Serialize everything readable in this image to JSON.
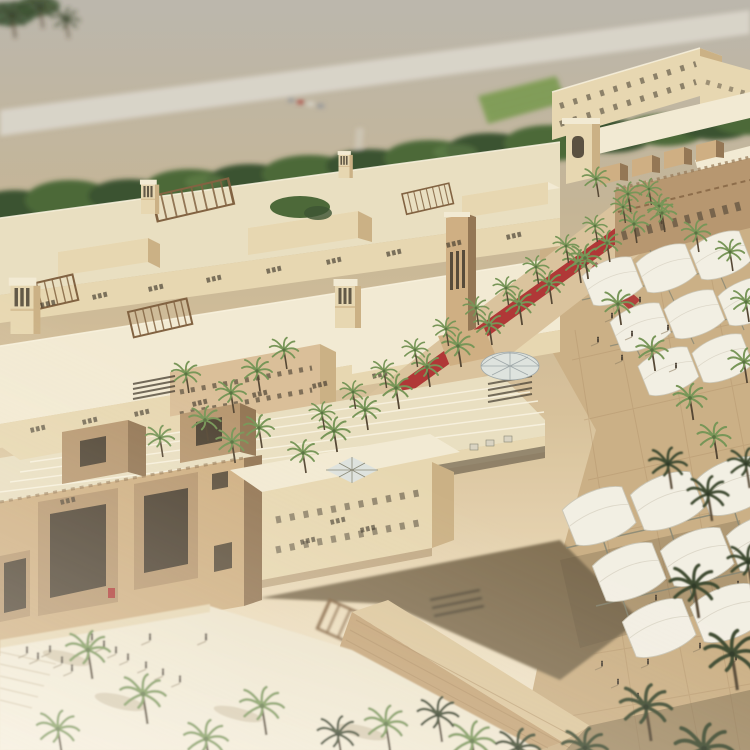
{
  "palette": {
    "desert": "#b8b4ab",
    "road": "#d7d3c9",
    "tree_dark": "#2f4a28",
    "tree_mid": "#41602f",
    "tree_light": "#5b7d42",
    "roof_light": "#f3ebd4",
    "roof_mid": "#e9dfc1",
    "wall_lit": "#e7d7b0",
    "wall_shadow": "#c9ae81",
    "wall_deep": "#9a7c55",
    "sandstone_lit": "#cdac7e",
    "sandstone_mid": "#b3926a",
    "sandstone_shadow": "#8d6f4d",
    "carpet_red": "#a81f24",
    "palm_green": "#6f9150",
    "palm_dark": "#333f27",
    "trunk": "#4b3d2b",
    "canopy_white": "#f3f0e6",
    "canopy_shade": "#e2ded0",
    "frame_gray": "#80816f",
    "paver": "#c9ad82",
    "paver_shade": "#9b8260",
    "plaza_bright": "#f2ecdc",
    "wall_brick": "#c2a073",
    "brick_course": "#a5845a",
    "glass_light": "#dde3e0",
    "wood": "#7a5a38",
    "opening_dark": "#352d22",
    "facade_pink": "#d9bd96",
    "avenue_sand": "#d9c19a",
    "people": "#3f362b",
    "person_shadow": "#8a795d",
    "grid_line": "#a7885e",
    "parapet_light": "#faf4e2",
    "crop_green": "#7d9b52",
    "crop_row": "#5d7a3c",
    "step_line": "#cdbfa2",
    "shadow_warm": "#6b5a41",
    "car_red": "#a8433a",
    "car_gray": "#8b9095",
    "car_light": "#d8d5cc"
  },
  "scene": {
    "palms": [
      {
        "x": 12,
        "y": 16,
        "s": 1.1,
        "v": "dark",
        "l": "far"
      },
      {
        "x": 40,
        "y": 8,
        "s": 1.0,
        "v": "dark",
        "l": "far"
      },
      {
        "x": 66,
        "y": 20,
        "s": 0.9,
        "v": "dark",
        "l": "far"
      },
      {
        "x": 303,
        "y": 453,
        "s": 1.0
      },
      {
        "x": 334,
        "y": 431,
        "s": 1.05
      },
      {
        "x": 365,
        "y": 410,
        "s": 1.0
      },
      {
        "x": 396,
        "y": 388,
        "s": 1.05
      },
      {
        "x": 427,
        "y": 367,
        "s": 1.0
      },
      {
        "x": 458,
        "y": 346,
        "s": 1.05
      },
      {
        "x": 489,
        "y": 325,
        "s": 1.0
      },
      {
        "x": 519,
        "y": 304,
        "s": 1.05
      },
      {
        "x": 549,
        "y": 284,
        "s": 1.0
      },
      {
        "x": 578,
        "y": 263,
        "s": 1.0
      },
      {
        "x": 607,
        "y": 243,
        "s": 0.95
      },
      {
        "x": 634,
        "y": 224,
        "s": 0.95
      },
      {
        "x": 659,
        "y": 206,
        "s": 0.9
      },
      {
        "x": 322,
        "y": 413,
        "s": 0.85
      },
      {
        "x": 353,
        "y": 392,
        "s": 0.85
      },
      {
        "x": 384,
        "y": 371,
        "s": 0.85
      },
      {
        "x": 415,
        "y": 350,
        "s": 0.85
      },
      {
        "x": 446,
        "y": 329,
        "s": 0.85
      },
      {
        "x": 476,
        "y": 308,
        "s": 0.85
      },
      {
        "x": 506,
        "y": 288,
        "s": 0.85
      },
      {
        "x": 536,
        "y": 267,
        "s": 0.85
      },
      {
        "x": 566,
        "y": 246,
        "s": 0.85
      },
      {
        "x": 595,
        "y": 226,
        "s": 0.8
      },
      {
        "x": 623,
        "y": 207,
        "s": 0.8
      },
      {
        "x": 649,
        "y": 189,
        "s": 0.8
      },
      {
        "x": 231,
        "y": 393,
        "s": 1.0
      },
      {
        "x": 257,
        "y": 371,
        "s": 1.0
      },
      {
        "x": 284,
        "y": 350,
        "s": 0.95
      },
      {
        "x": 205,
        "y": 420,
        "s": 1.05
      },
      {
        "x": 232,
        "y": 442,
        "s": 1.05
      },
      {
        "x": 186,
        "y": 374,
        "s": 0.95
      },
      {
        "x": 259,
        "y": 428,
        "s": 1.0
      },
      {
        "x": 160,
        "y": 438,
        "s": 0.95
      },
      {
        "x": 585,
        "y": 258,
        "s": 1.05
      },
      {
        "x": 618,
        "y": 304,
        "s": 1.05
      },
      {
        "x": 652,
        "y": 350,
        "s": 1.05
      },
      {
        "x": 690,
        "y": 398,
        "s": 1.1
      },
      {
        "x": 714,
        "y": 437,
        "s": 1.1
      },
      {
        "x": 596,
        "y": 179,
        "s": 0.9
      },
      {
        "x": 628,
        "y": 194,
        "s": 0.9
      },
      {
        "x": 662,
        "y": 213,
        "s": 0.95
      },
      {
        "x": 696,
        "y": 233,
        "s": 0.95
      },
      {
        "x": 730,
        "y": 252,
        "s": 0.95
      },
      {
        "x": 746,
        "y": 302,
        "s": 1.0
      },
      {
        "x": 744,
        "y": 362,
        "s": 1.05
      },
      {
        "x": 88,
        "y": 650,
        "s": 1.45,
        "l": "f"
      },
      {
        "x": 143,
        "y": 694,
        "s": 1.5,
        "l": "f"
      },
      {
        "x": 262,
        "y": 706,
        "s": 1.45,
        "l": "f"
      },
      {
        "x": 386,
        "y": 724,
        "s": 1.4,
        "l": "f"
      },
      {
        "x": 58,
        "y": 729,
        "s": 1.4,
        "l": "f"
      },
      {
        "x": 472,
        "y": 741,
        "s": 1.5,
        "l": "f"
      },
      {
        "x": 206,
        "y": 739,
        "s": 1.45,
        "l": "f"
      },
      {
        "x": 668,
        "y": 464,
        "s": 1.25,
        "v": "dark",
        "l": "f"
      },
      {
        "x": 708,
        "y": 494,
        "s": 1.35,
        "v": "dark",
        "l": "f"
      },
      {
        "x": 746,
        "y": 464,
        "s": 1.2,
        "v": "dark",
        "l": "f"
      },
      {
        "x": 694,
        "y": 586,
        "s": 1.6,
        "v": "dark",
        "l": "f"
      },
      {
        "x": 732,
        "y": 654,
        "s": 1.8,
        "v": "dark",
        "l": "f"
      },
      {
        "x": 646,
        "y": 707,
        "s": 1.7,
        "v": "dark",
        "l": "f"
      },
      {
        "x": 585,
        "y": 748,
        "s": 1.5,
        "v": "dark",
        "l": "f"
      },
      {
        "x": 704,
        "y": 749,
        "s": 1.9,
        "v": "dark",
        "l": "f"
      },
      {
        "x": 748,
        "y": 562,
        "s": 1.35,
        "v": "dark",
        "l": "f"
      },
      {
        "x": 438,
        "y": 715,
        "s": 1.35,
        "v": "dark",
        "l": "f"
      },
      {
        "x": 338,
        "y": 734,
        "s": 1.35,
        "v": "dark",
        "l": "f"
      },
      {
        "x": 518,
        "y": 748,
        "s": 1.45,
        "v": "dark",
        "l": "f"
      }
    ],
    "people": [
      {
        "x": 612,
        "y": 318
      },
      {
        "x": 632,
        "y": 336
      },
      {
        "x": 652,
        "y": 352
      },
      {
        "x": 668,
        "y": 330
      },
      {
        "x": 640,
        "y": 302
      },
      {
        "x": 622,
        "y": 360
      },
      {
        "x": 598,
        "y": 342
      },
      {
        "x": 676,
        "y": 368
      },
      {
        "x": 586,
        "y": 652
      },
      {
        "x": 602,
        "y": 666
      },
      {
        "x": 618,
        "y": 684
      },
      {
        "x": 638,
        "y": 698
      },
      {
        "x": 566,
        "y": 630
      },
      {
        "x": 648,
        "y": 664
      },
      {
        "x": 664,
        "y": 644
      },
      {
        "x": 680,
        "y": 624
      },
      {
        "x": 700,
        "y": 648
      },
      {
        "x": 716,
        "y": 628
      },
      {
        "x": 736,
        "y": 660
      },
      {
        "x": 626,
        "y": 628
      },
      {
        "x": 592,
        "y": 610
      },
      {
        "x": 656,
        "y": 600
      },
      {
        "x": 690,
        "y": 588
      },
      {
        "x": 712,
        "y": 566
      },
      {
        "x": 738,
        "y": 586
      },
      {
        "x": 608,
        "y": 560
      },
      {
        "x": 576,
        "y": 586
      },
      {
        "x": 640,
        "y": 570
      },
      {
        "x": 27,
        "y": 653,
        "l": "f"
      },
      {
        "x": 38,
        "y": 659,
        "l": "f"
      },
      {
        "x": 50,
        "y": 652,
        "l": "f"
      },
      {
        "x": 62,
        "y": 663,
        "l": "f"
      },
      {
        "x": 92,
        "y": 640,
        "l": "f"
      },
      {
        "x": 104,
        "y": 647,
        "l": "f"
      },
      {
        "x": 116,
        "y": 653,
        "l": "f"
      },
      {
        "x": 128,
        "y": 660,
        "l": "f"
      },
      {
        "x": 146,
        "y": 668,
        "l": "f"
      },
      {
        "x": 163,
        "y": 675,
        "l": "f"
      },
      {
        "x": 180,
        "y": 682,
        "l": "f"
      },
      {
        "x": 72,
        "y": 671,
        "l": "f"
      },
      {
        "x": 206,
        "y": 640,
        "l": "f"
      },
      {
        "x": 150,
        "y": 640,
        "l": "f"
      }
    ],
    "vents": [
      {
        "x": 40,
        "y": 303
      },
      {
        "x": 92,
        "y": 295
      },
      {
        "x": 148,
        "y": 287
      },
      {
        "x": 206,
        "y": 278
      },
      {
        "x": 266,
        "y": 269
      },
      {
        "x": 326,
        "y": 260
      },
      {
        "x": 386,
        "y": 252
      },
      {
        "x": 446,
        "y": 243
      },
      {
        "x": 506,
        "y": 235
      },
      {
        "x": 30,
        "y": 428
      },
      {
        "x": 82,
        "y": 420
      },
      {
        "x": 134,
        "y": 412
      },
      {
        "x": 192,
        "y": 402
      },
      {
        "x": 252,
        "y": 393
      },
      {
        "x": 312,
        "y": 384
      },
      {
        "x": 372,
        "y": 374
      },
      {
        "x": 60,
        "y": 500
      },
      {
        "x": 330,
        "y": 520
      },
      {
        "x": 300,
        "y": 540
      },
      {
        "x": 360,
        "y": 528
      }
    ]
  }
}
